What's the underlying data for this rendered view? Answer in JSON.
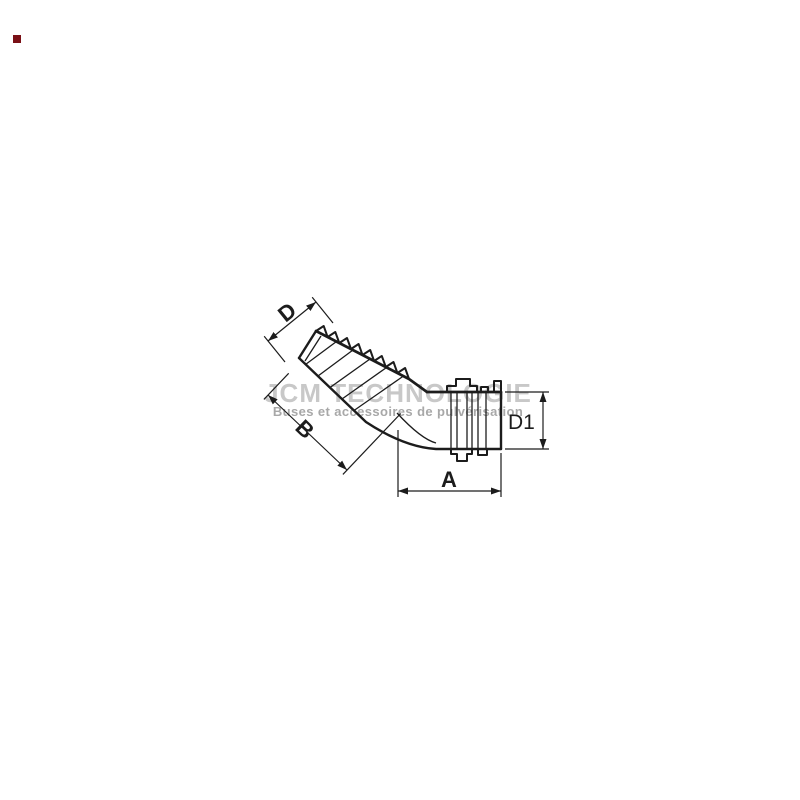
{
  "canvas": {
    "width": 800,
    "height": 800,
    "background": "#ffffff"
  },
  "watermark": {
    "title": "JCM TECHNOLOGIE",
    "subtitle": "Buses et accessoires de pulvérisation",
    "title_color": "#c8c8c8",
    "subtitle_color": "#a8a8a8"
  },
  "drawing": {
    "description": "Dimensioned outline drawing of a 45-degree elbow hose barb fitting",
    "line_color": "#1c1c1c"
  },
  "dimensions": {
    "d": "D",
    "b": "B",
    "a": "A",
    "d1": "D1"
  },
  "logo": {
    "color": "#7a1016"
  }
}
